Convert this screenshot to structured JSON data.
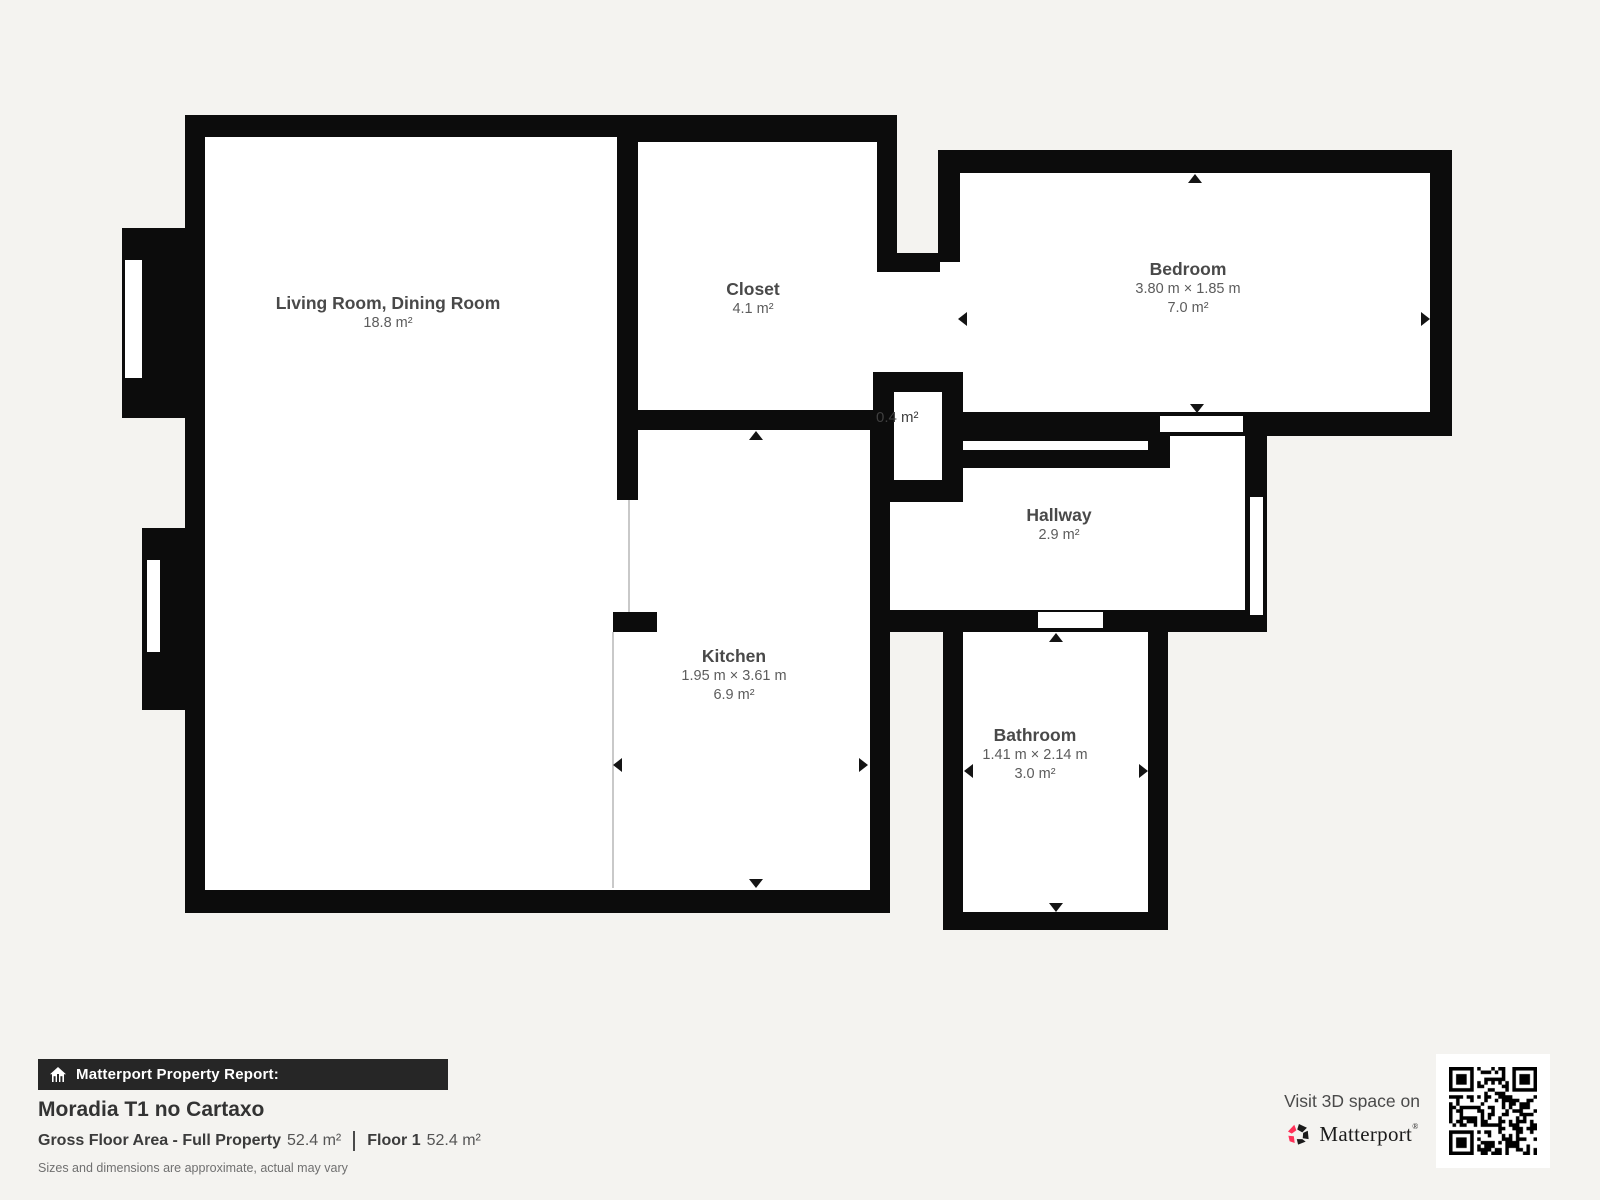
{
  "floorplan": {
    "rooms": [
      {
        "id": "living",
        "name": "Living Room, Dining Room",
        "area": "18.8 m²"
      },
      {
        "id": "closet",
        "name": "Closet",
        "area": "4.1 m²"
      },
      {
        "id": "bedroom",
        "name": "Bedroom",
        "dims": "3.80 m × 1.85 m",
        "area": "7.0 m²"
      },
      {
        "id": "small_closet",
        "name": "",
        "area": "0.4 m²"
      },
      {
        "id": "hallway",
        "name": "Hallway",
        "area": "2.9 m²"
      },
      {
        "id": "kitchen",
        "name": "Kitchen",
        "dims": "1.95 m × 3.61 m",
        "area": "6.9 m²"
      },
      {
        "id": "bathroom",
        "name": "Bathroom",
        "dims": "1.41 m × 2.14 m",
        "area": "3.0 m²"
      }
    ]
  },
  "footer": {
    "report_label": "Matterport Property Report:",
    "property_name": "Moradia T1 no Cartaxo",
    "gross_label": "Gross Floor Area - Full Property",
    "gross_value": "52.4 m²",
    "floor_label": "Floor 1",
    "floor_value": "52.4 m²",
    "disclaimer": "Sizes and dimensions are approximate, actual may vary",
    "visit_text": "Visit 3D space on",
    "brand": "Matterport",
    "trademark": "®"
  },
  "colors": {
    "wall": "#0c0c0c",
    "background": "#f4f3f0",
    "room_fill": "#ffffff",
    "accent_red": "#ff3158",
    "footer_bar": "#262626",
    "label_text": "#494949"
  }
}
